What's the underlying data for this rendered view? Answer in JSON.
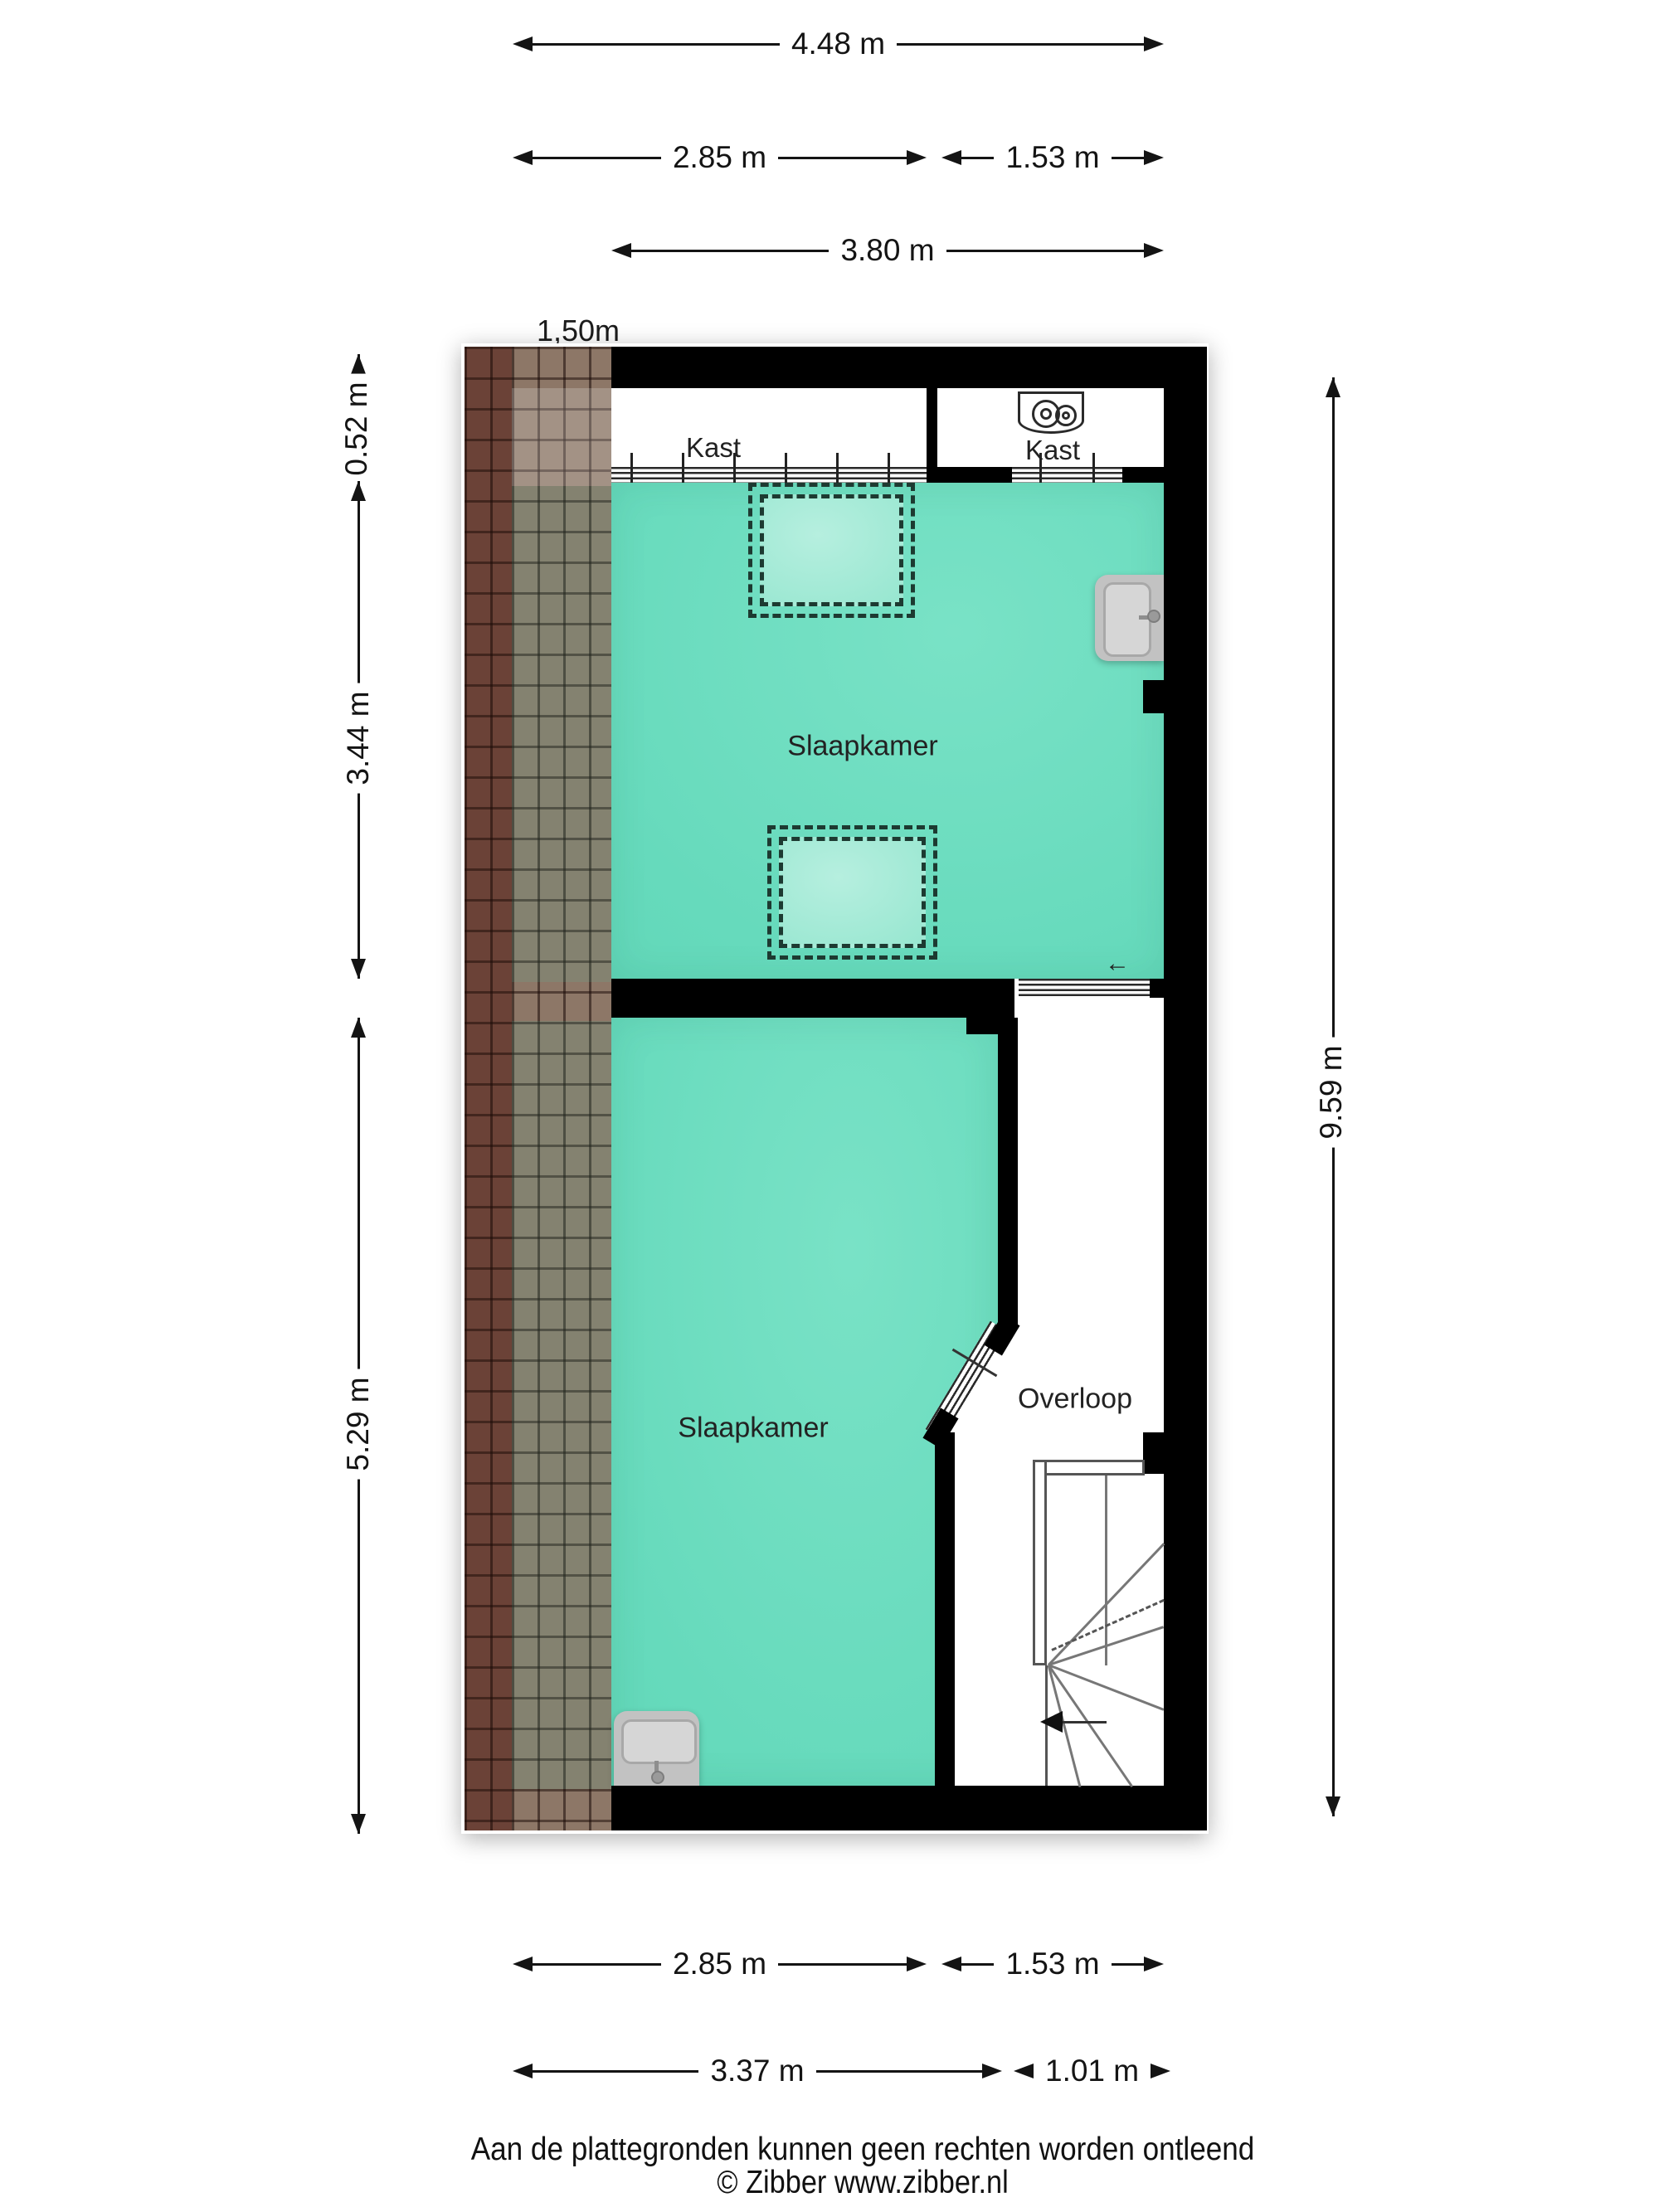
{
  "dimensions": {
    "top": [
      {
        "id": "total-width",
        "label": "4.48 m"
      },
      {
        "id": "bedroom-top-width",
        "label": "2.85 m"
      },
      {
        "id": "closet-right-width",
        "label": "1.53 m"
      },
      {
        "id": "bedroom-top-floor-width",
        "label": "3.80 m"
      }
    ],
    "roof_height_line": "1,50m",
    "left": [
      {
        "id": "closet-depth",
        "label": "0.52 m"
      },
      {
        "id": "bedroom-top-depth",
        "label": "3.44 m"
      },
      {
        "id": "bedroom-bottom-depth",
        "label": "5.29 m"
      }
    ],
    "right": [
      {
        "id": "total-depth",
        "label": "9.59 m"
      }
    ],
    "bottom": [
      {
        "id": "bedroom-bottom-width",
        "label": "2.85 m"
      },
      {
        "id": "landing-width",
        "label": "1.53 m"
      },
      {
        "id": "bedroom-bottom-total-width",
        "label": "3.37 m"
      },
      {
        "id": "stairs-width",
        "label": "1.01 m"
      }
    ]
  },
  "rooms": [
    {
      "id": "kast-left",
      "label": "Kast"
    },
    {
      "id": "kast-right",
      "label": "Kast"
    },
    {
      "id": "slaapkamer-top",
      "label": "Slaapkamer"
    },
    {
      "id": "slaapkamer-bottom",
      "label": "Slaapkamer"
    },
    {
      "id": "overloop",
      "label": "Overloop"
    }
  ],
  "symbols": {
    "door_direction_arrow": "←"
  },
  "footer": {
    "disclaimer": "Aan de plattegronden kunnen geen rechten worden ontleend",
    "credit": "© Zibber www.zibber.nl"
  },
  "colors": {
    "room_fill": "#66dabc",
    "skylight_fill": "#99e7d1",
    "wall": "#000000",
    "roof_dark": "#6b4237",
    "roof_light": "#8d7767",
    "dimension_text": "#141414"
  }
}
